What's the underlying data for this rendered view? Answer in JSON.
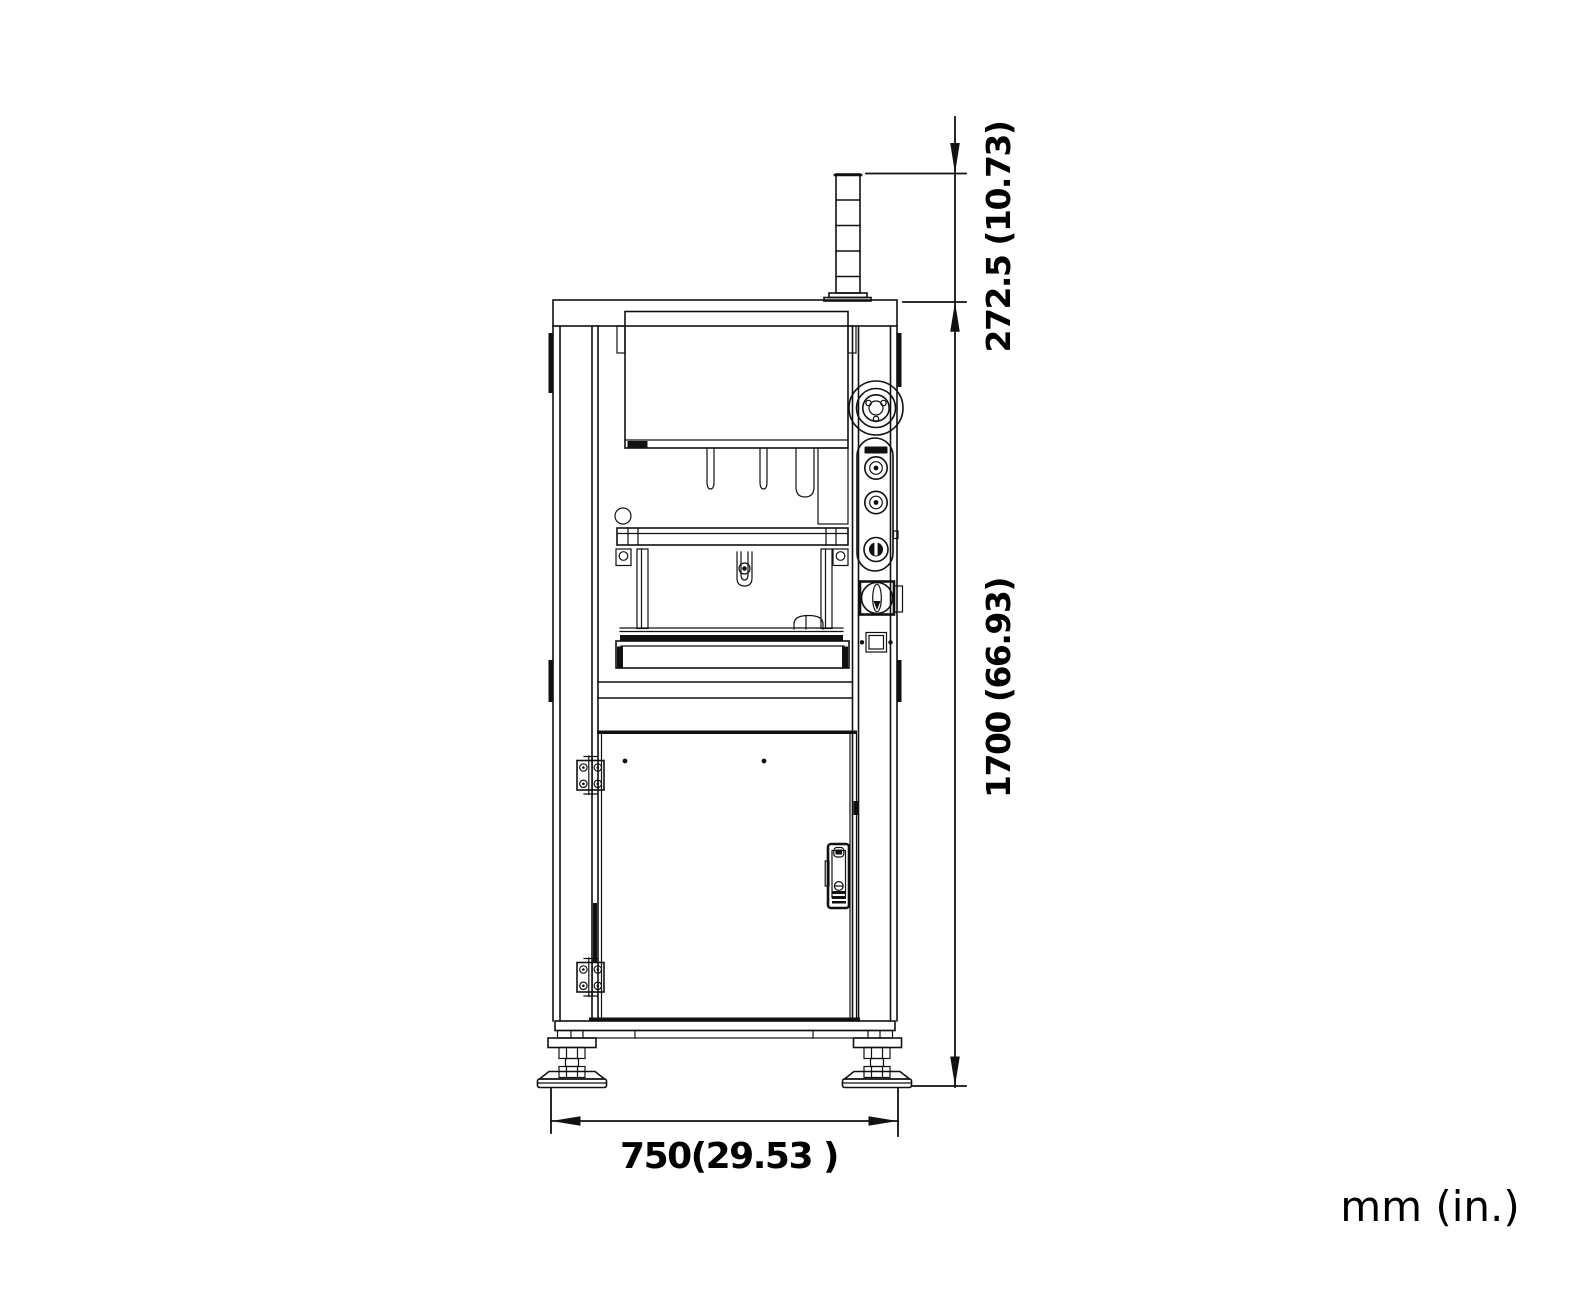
{
  "meta": {
    "background_color": "#ffffff",
    "line_color": "#111111",
    "view": "machine front elevation technical drawing"
  },
  "drawing": {
    "dimensions": {
      "upper_height_label": "272.5 (10.73)",
      "overall_height_label": "1700 (66.93)",
      "overall_width_label": "750(29.53 )"
    },
    "units_note": "mm (in.)"
  }
}
